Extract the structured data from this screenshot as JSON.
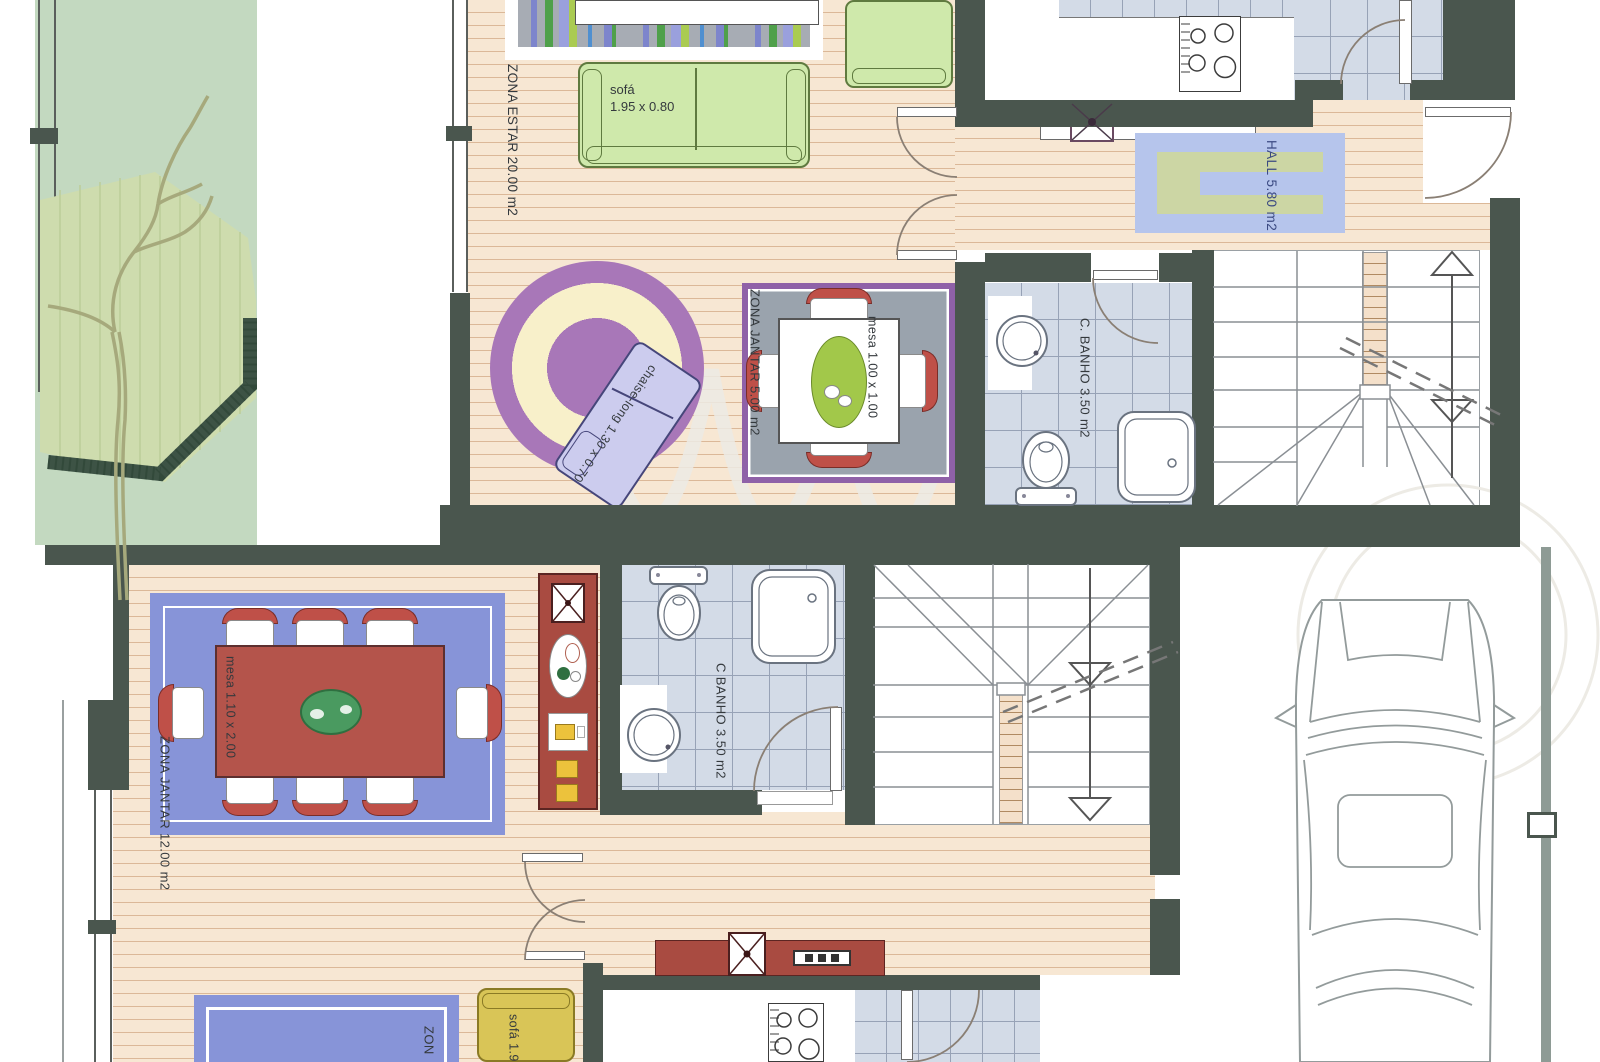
{
  "rooms": {
    "upper": {
      "living": {
        "label": "ZONA ESTAR",
        "area": "20.00 m2"
      },
      "dining": {
        "label": "ZONA JANTAR",
        "area": "5.00 m2"
      },
      "hall": {
        "label": "HALL",
        "area": "5.80 m2"
      },
      "bath": {
        "label": "C. BANHO",
        "area": "3.50 m2"
      }
    },
    "lower": {
      "dining": {
        "label": "ZONA JANTAR",
        "area": "12.00 m2"
      },
      "bath": {
        "label": "C BANHO",
        "area": "3.50 m2"
      },
      "living_partial": {
        "label": "ZON"
      }
    }
  },
  "furniture": {
    "upper_sofa": {
      "label": "sofá",
      "dim": "1.95 x 0.80"
    },
    "chaise": {
      "label": "chaise-long",
      "dim": "1.30 x 0.70"
    },
    "upper_table": {
      "label": "mesa",
      "dim": "1.00 x 1.00"
    },
    "lower_table": {
      "label": "mesa",
      "dim": "1.10 x 2.00"
    },
    "lower_sofa": {
      "label": "sofá",
      "dim": "1.95 x"
    }
  },
  "colors": {
    "wall": "#4a564e",
    "wood_floor": "#f7e7d3",
    "bath_tile": "#d3dbe7",
    "garden_green": "#c3d9c0",
    "hedge_green": "#3d5345",
    "hall_rug_blue": "#b6c5ec",
    "hall_rug_green": "#ccd6a4",
    "dining_rug_blue": "#8794d8",
    "dining_rug_gray": "#9aa3ad",
    "rug_border_purple": "#8f61a8",
    "round_rug_purple": "#a877b8",
    "round_rug_cream": "#f8f0ca",
    "chaise_lavender": "#ccccee",
    "sofa_green": "#cfe9ab",
    "sofa_yellow": "#d9c557",
    "table_red": "#b4544b",
    "sideboard_red": "#a94b41",
    "chair_red": "#bf5048",
    "accent_yellow": "#ecc23c"
  }
}
